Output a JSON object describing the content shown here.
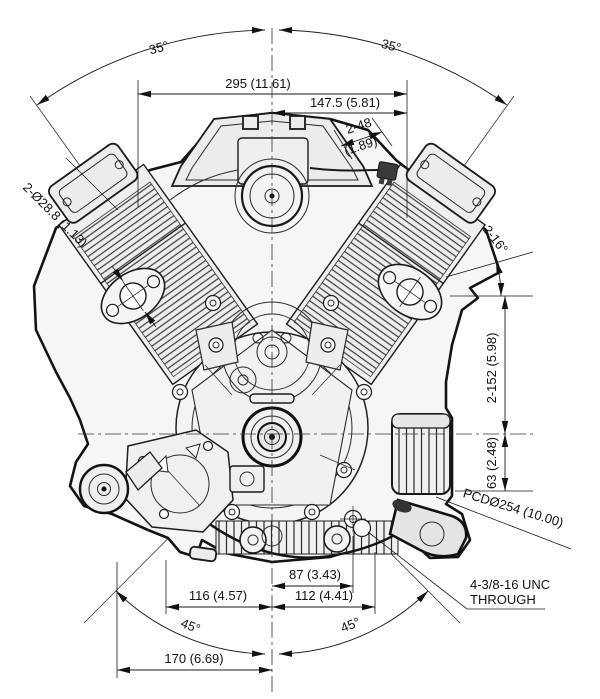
{
  "drawing": {
    "type": "engine-dimension-diagram",
    "description": "V-twin engine front view with installation dimensions, mm (inches)",
    "colors": {
      "line": "#1a1a1a",
      "body_fill": "#f6f6f6",
      "panel_fill": "#ececec",
      "fin_fill": "#ededed",
      "dark_part": "#333333"
    },
    "dimensions": {
      "top_angle_left": "35°",
      "top_angle_right": "35°",
      "overall_width": "295 (11.61)",
      "half_width": "147.5 (5.81)",
      "stud_spacing_line1": "2-48",
      "stud_spacing_line2": "(1.89)",
      "exhaust_ports": "2-Ø28.8 (1.13)",
      "head_face_angle": "2-16°",
      "crank_to_head_top": "2-152 (5.98)",
      "crank_to_mount_face": "63 (2.48)",
      "bolt_circle": "PCDØ254 (10.00)",
      "mount_span_87": "87 (3.43)",
      "mount_span_116": "116 (4.57)",
      "mount_span_112": "112 (4.41)",
      "bottom_angle_left": "45°",
      "bottom_angle_right": "45°",
      "mount_span_170": "170 (6.69)",
      "bolt_spec_line1": "4-3/8-16 UNC",
      "bolt_spec_line2": "THROUGH"
    }
  }
}
